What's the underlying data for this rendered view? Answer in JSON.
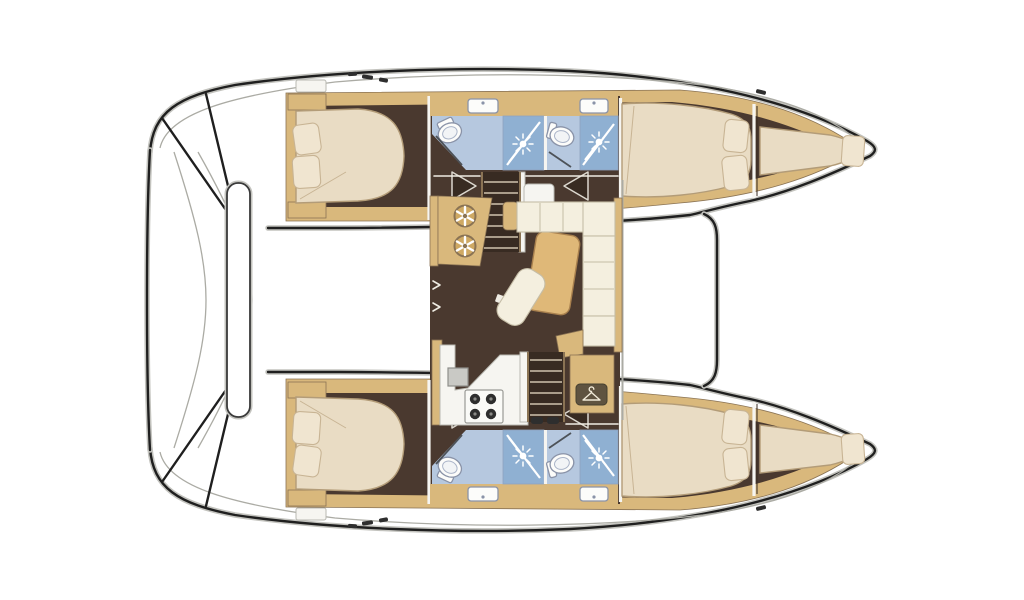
{
  "meta": {
    "title": "Catamaran interior layout floor plan (top-down deck view)",
    "vessel_type": "sailing catamaran",
    "visible_text": []
  },
  "palette": {
    "outline": "#1f1f1f",
    "shadow": "#c3c3be",
    "deck": "#ffffff",
    "deck-line": "#ababa4",
    "wood": "#d9b87c",
    "wood-edge": "#8a7354",
    "floor": "#4a392f",
    "floor-deep": "#382b22",
    "mattress": "#e9dcc4",
    "mattress-edge": "#b39c78",
    "pillow": "#f0e5d0",
    "pillow-edge": "#c8b494",
    "cushion": "#f4efdf",
    "cushion-edge": "#c5bda6",
    "bath": "#b6c8df",
    "bath-deep": "#8fb0d2",
    "bath-line": "#8fa3c0",
    "fixture": "#fcfcfa",
    "fixture-edge": "#8a93a8",
    "counter": "#f6f5f1",
    "counter-edge": "#b9b9b2",
    "tread": "#cfc3ae",
    "fitting": "#2e2e2e",
    "badge": "#5f5340",
    "table": "#dfb878",
    "table-edge": "#a8804e",
    "wheel": "#cfa963",
    "sinkgray": "#c9c9c5"
  },
  "counts": {
    "hulls": 2,
    "double_cabins": 4,
    "bathrooms": 4,
    "showers": 4,
    "toilets": 4,
    "sinks": 4,
    "forepeak_berths": 2,
    "pillows": 10,
    "stove_burners": 4,
    "helm_wheel_dials": 2,
    "companionway_stairs": 2
  },
  "regions": {
    "cockpit": "aft cockpit with bench seat",
    "saloon": "central saloon with L-sofa, table and chaise pad",
    "galley": "galley with sink and 4-burner stove",
    "nav_station": "chart desk with two wheel dials",
    "wardrobe": "wardrobe locker marked with hanger icon",
    "port_hull": "upper hull: aft cabin, two bathrooms, forward cabin, forepeak berth",
    "starboard_hull": "lower hull: aft cabin, two bathrooms, forward cabin, forepeak berth",
    "foredeck": "open foredeck between bows with crossbeam"
  },
  "icons": [
    {
      "name": "shower-head-icon",
      "glyph": "white sunburst on blue shower pan"
    },
    {
      "name": "toilet-icon",
      "glyph": "white oval bowl with seat ring"
    },
    {
      "name": "sink-icon",
      "glyph": "white rounded basin with faucet dot"
    },
    {
      "name": "hanger-icon",
      "glyph": "white clothes hanger in dark rounded badge"
    },
    {
      "name": "stove-icon",
      "glyph": "four dark burner circles on white hob"
    },
    {
      "name": "wheel-dial-icon",
      "glyph": "spoked wheel on tan desk"
    },
    {
      "name": "step-arrow-icon",
      "glyph": "white-edged triangle marking companionway"
    }
  ]
}
